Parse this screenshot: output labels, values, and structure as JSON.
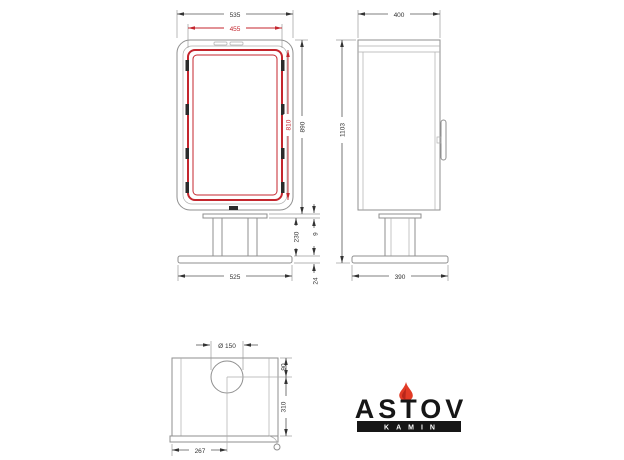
{
  "drawing": {
    "front": {
      "width_overall": "535",
      "width_door": "455",
      "height_body": "890",
      "height_door": "810",
      "plate_thickness": "9",
      "pedestal_height": "230",
      "base_thickness": "24",
      "base_width": "525"
    },
    "side": {
      "depth_overall": "400",
      "height_total": "1103",
      "base_depth": "390"
    },
    "top": {
      "flue_diameter": "Ø 150",
      "flue_to_back": "90",
      "flue_to_front": "310",
      "flue_center_offset": "267"
    }
  },
  "logo": {
    "brand": "ASTOV",
    "subtitle": "KAMIN"
  },
  "colors": {
    "line_gray": "#8f8f8f",
    "dim_dark": "#333333",
    "accent_red": "#c4262e",
    "logo_black": "#161616",
    "flame_red": "#e23b26"
  }
}
